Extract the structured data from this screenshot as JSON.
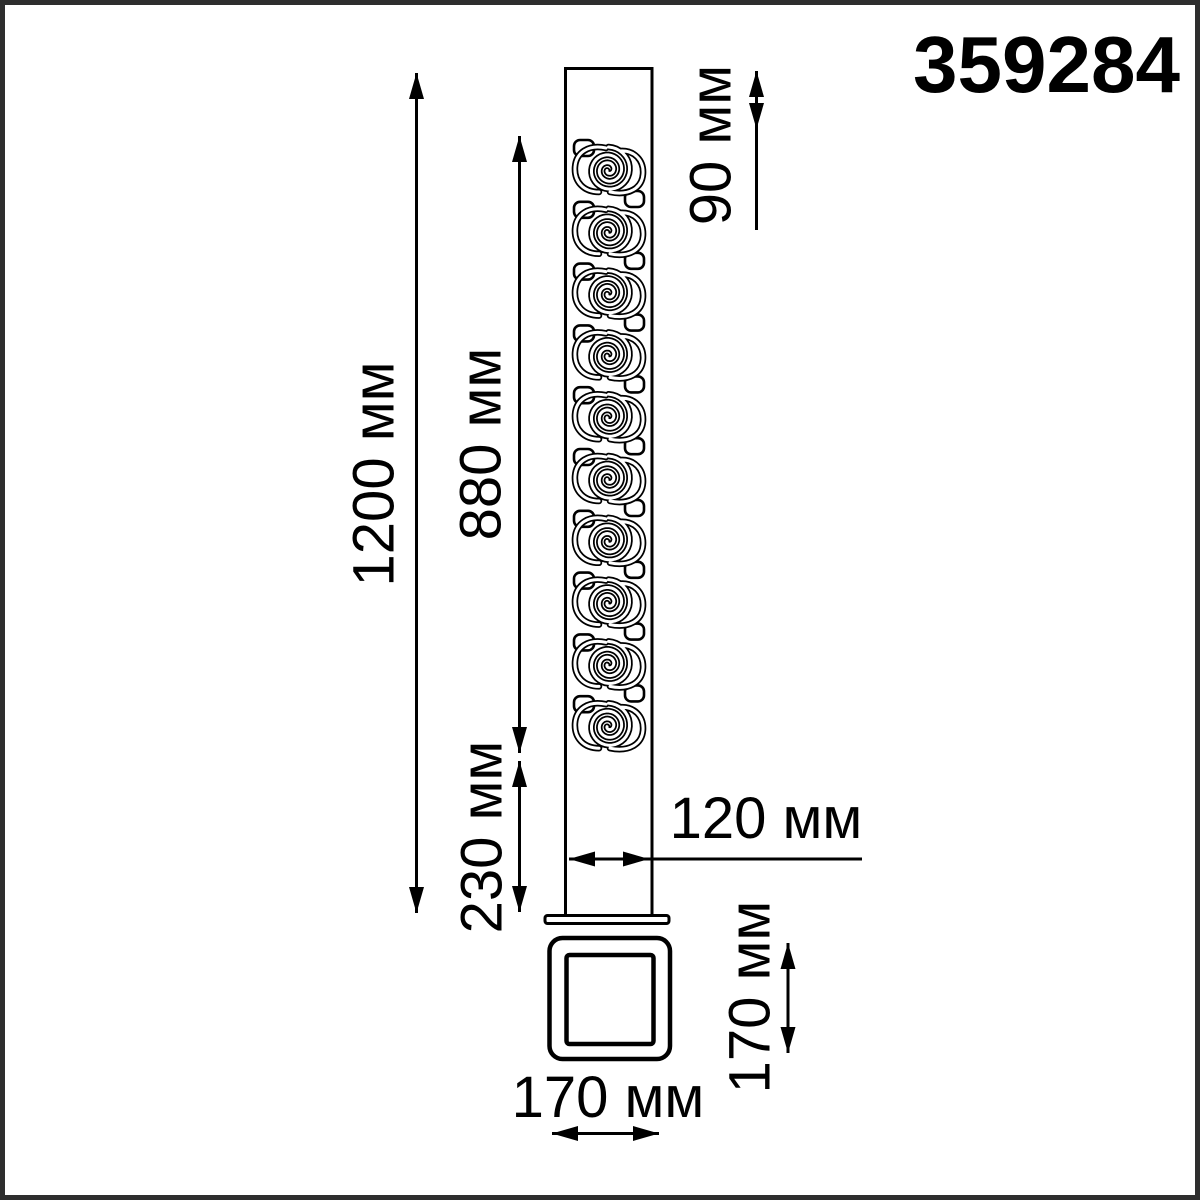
{
  "product_code": "359284",
  "units": "мм",
  "dimensions": {
    "total_height": {
      "label": "1200 мм",
      "value_mm": 1200
    },
    "decorative_section": {
      "label": "880 мм",
      "value_mm": 880
    },
    "lower_section": {
      "label": "230 мм",
      "value_mm": 230
    },
    "top_section": {
      "label": "90 мм",
      "value_mm": 90
    },
    "pole_width": {
      "label": "120 мм",
      "value_mm": 120
    },
    "base_plate_height": {
      "label": "170 мм",
      "value_mm": 170
    },
    "base_plate_width": {
      "label": "170 мм",
      "value_mm": 170
    }
  },
  "colors": {
    "line": "#000000",
    "background": "#ffffff",
    "frame_border": "#2e2e2e"
  },
  "pattern": {
    "style": "vitruvian-scroll",
    "spiral_count": 10
  }
}
